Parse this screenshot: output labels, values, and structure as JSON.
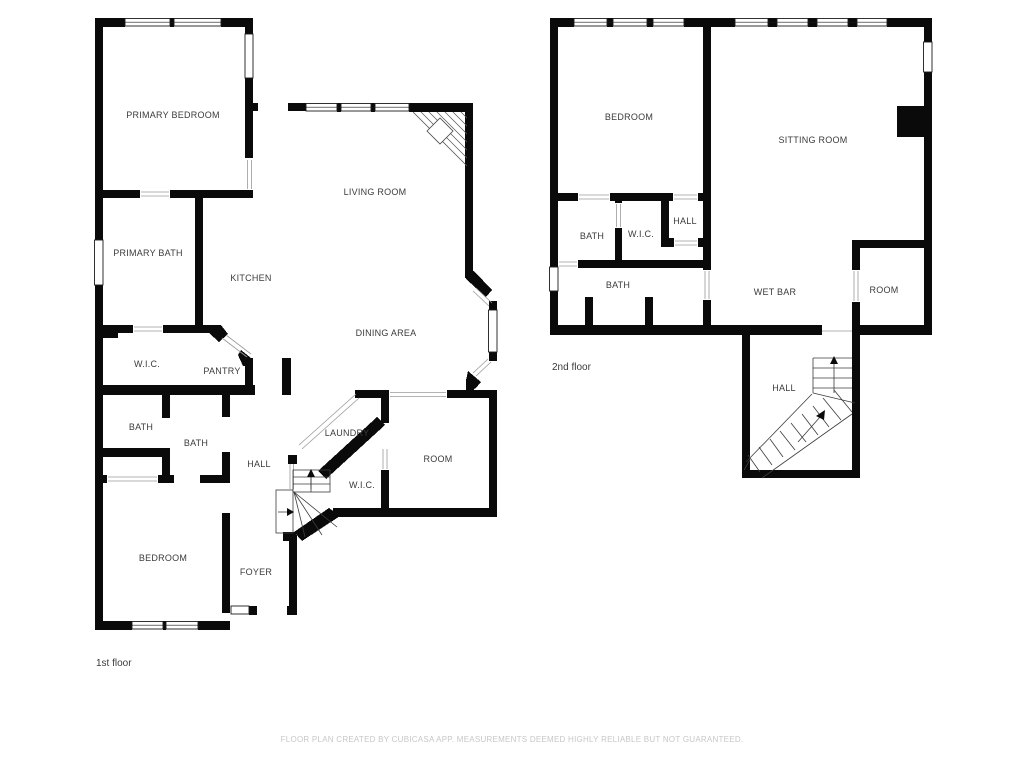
{
  "page": {
    "background": "#ffffff"
  },
  "floors": [
    {
      "name": "1st floor",
      "rooms": [
        "PRIMARY BEDROOM",
        "LIVING ROOM",
        "PRIMARY BATH",
        "KITCHEN",
        "DINING AREA",
        "W.I.C.",
        "PANTRY",
        "BATH",
        "BATH",
        "HALL",
        "LAUNDRY",
        "ROOM",
        "W.I.C.",
        "BEDROOM",
        "FOYER"
      ]
    },
    {
      "name": "2nd floor",
      "rooms": [
        "BEDROOM",
        "SITTING ROOM",
        "BATH",
        "W.I.C.",
        "HALL",
        "BATH",
        "WET BAR",
        "ROOM",
        "HALL"
      ]
    }
  ],
  "footer": {
    "disclaimer": "FLOOR PLAN CREATED BY CUBICASA APP. MEASUREMENTS DEEMED HIGHLY RELIABLE BUT NOT GUARANTEED."
  },
  "colors": {
    "wall": "#0a0a0a",
    "room_label": "#3b3b3b",
    "floor_label": "#3b3b3b",
    "footer_text": "#c7c7c7",
    "background": "#ffffff"
  }
}
